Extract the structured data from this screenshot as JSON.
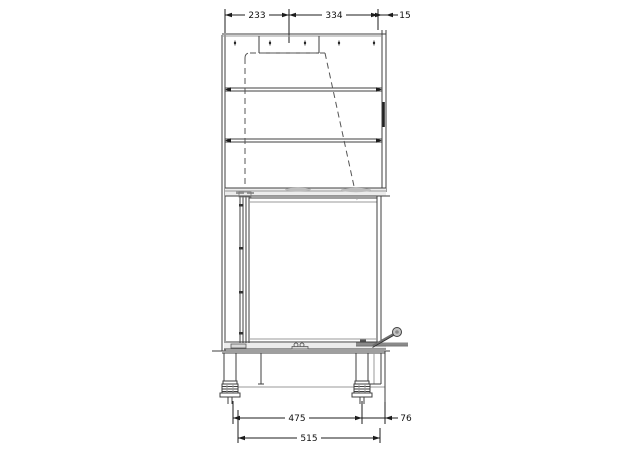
{
  "diagram": {
    "type": "technical-drawing-side-elevation",
    "colors": {
      "background": "#ffffff",
      "line": "#3f3f3f",
      "light_line": "#9a9a9a",
      "dimension_line": "#1c1c1c",
      "band_fill": "#ececec",
      "handle_fill": "#c4c4c4"
    },
    "dimensions": {
      "top": {
        "left": "233",
        "right": "334",
        "offset": "15"
      },
      "bottom": {
        "legs": "475",
        "offset": "76",
        "total": "515"
      }
    }
  }
}
